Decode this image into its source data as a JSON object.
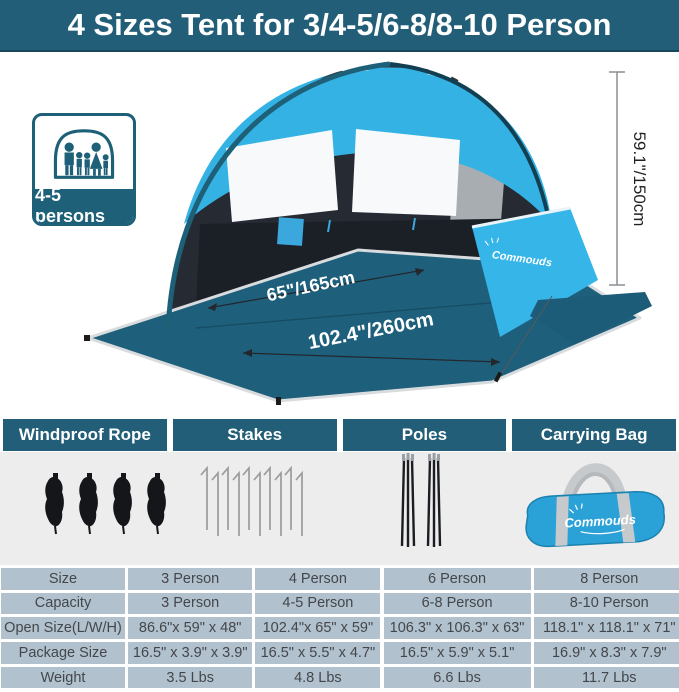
{
  "banner": {
    "title": "4 Sizes Tent for 3/4-5/6-8/8-10 Person"
  },
  "hero": {
    "badge": {
      "label": "4-5 persons",
      "icon": "family-in-tent-icon"
    },
    "dims": {
      "front_width": "65\"/165cm",
      "diagonal_width": "102.4\"/260cm",
      "height": "59.1\"/150cm"
    },
    "tent_brand": "Commouds"
  },
  "accessories": {
    "headers": [
      "Windproof Rope",
      "Stakes",
      "Poles",
      "Carrying Bag"
    ],
    "bag_brand": "Commouds"
  },
  "spec_table": {
    "rows": [
      [
        "Size",
        "3 Person",
        "4 Person",
        "6 Person",
        "8 Person"
      ],
      [
        "Capacity",
        "3 Person",
        "4-5 Person",
        "6-8 Person",
        "8-10 Person"
      ],
      [
        "Open Size(L/W/H)",
        "86.6\"x 59\" x 48\"",
        "102.4\"x 65\" x 59\"",
        "106.3\" x 106.3\" x 63\"",
        "118.1\" x 118.1\" x 71\""
      ],
      [
        "Package Size",
        "16.5\" x 3.9\" x 3.9\"",
        "16.5\" x 5.5\" x 4.7\"",
        "16.5\" x 5.9\" x 5.1\"",
        "16.9\" x 8.3\" x 7.9\""
      ],
      [
        "Weight",
        "3.5 Lbs",
        "4.8 Lbs",
        "6.6 Lbs",
        "11.7 Lbs"
      ]
    ]
  },
  "colors": {
    "teal": "#235e78",
    "canopy_blue": "#35b4e6",
    "floor_teal": "#1e5f7b",
    "table_bg": "#b2c1ce",
    "panel_gray": "#ededee"
  }
}
